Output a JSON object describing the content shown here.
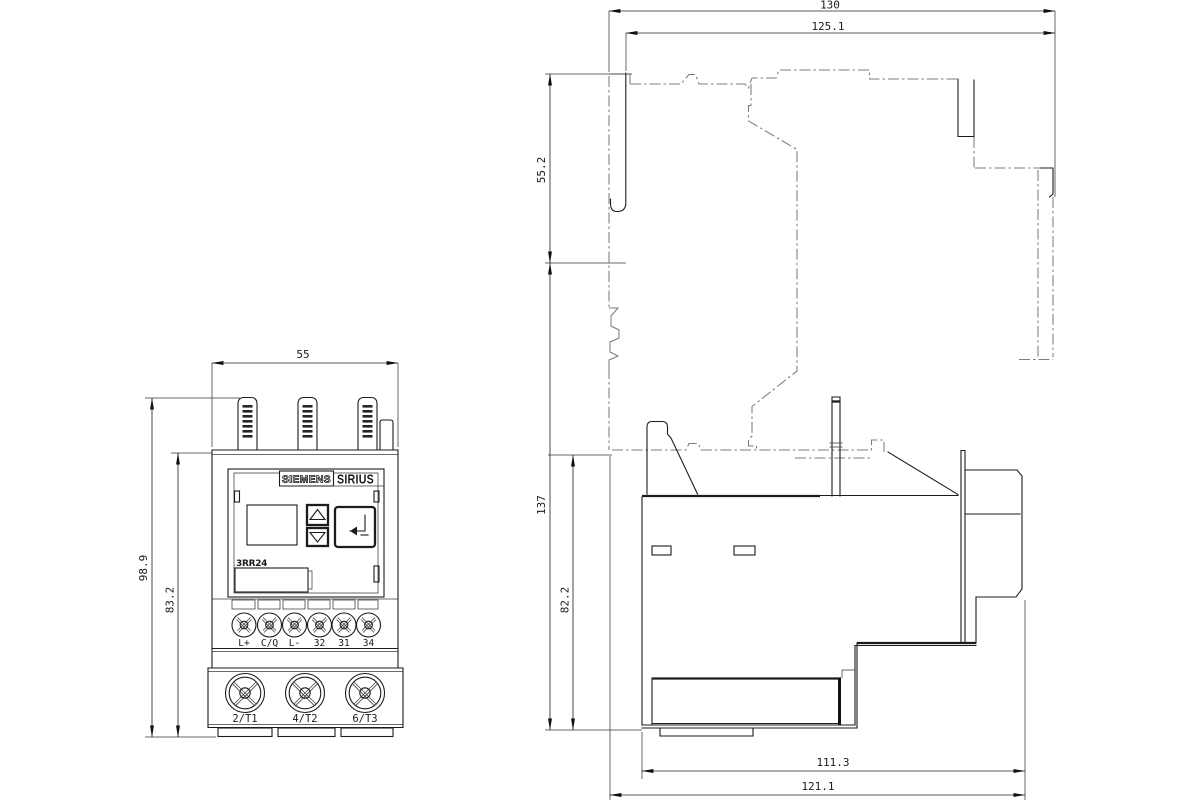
{
  "front_view": {
    "brand": "SIEMENS",
    "series": "SIRIUS",
    "model": "3RR24",
    "dims": {
      "width": "55",
      "height_total": "98.9",
      "height_body": "83.2"
    },
    "control_terminals": [
      "L+",
      "C/Q",
      "L-",
      "32",
      "31",
      "34"
    ],
    "main_terminals": [
      "2/T1",
      "4/T2",
      "6/T3"
    ]
  },
  "side_view": {
    "dims": {
      "width_total": "130",
      "width_mount": "125.1",
      "height_upper": "55.2",
      "height_total": "137",
      "height_body": "82.2",
      "depth_body": "111.3",
      "depth_total": "121.1"
    }
  }
}
